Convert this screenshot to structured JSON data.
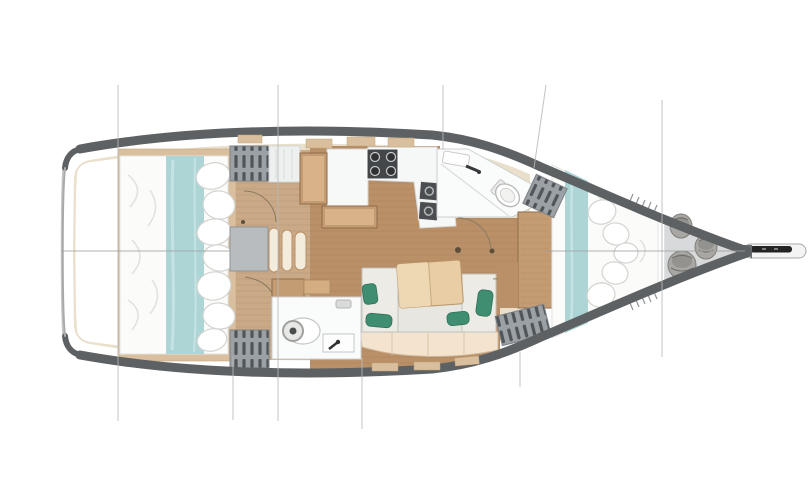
{
  "meta": {
    "type": "diagram",
    "subtype": "sailing-yacht-interior-floor-plan",
    "view": "top-down",
    "orientation": "bow-right, stern-left"
  },
  "palette": {
    "background": "#ffffff",
    "hull_band": "#5e6163",
    "hull_outline": "#c6c6c6",
    "transom_edge": "#a9a9a9",
    "deck_trim": "#e9dfca",
    "salon_floor": "#ba9069",
    "corridor_floor": "#caa987",
    "furniture_wood": "#c49c73",
    "table_wood": "#e8cda5",
    "bedding_white": "#fbfbfa",
    "accent_teal": "#aed5d6",
    "cushion_gray": "#ecebe5",
    "backrest_cream": "#f3e3cf",
    "pillow_green": "#3f8e71",
    "appliance_dark": "#44474a",
    "hanging_locker_gray": "#9ca1a6",
    "bow_locker_gray": "#d8d9da",
    "rope_gray": "#a8a7a3",
    "stairs_gray": "#b9bcbf",
    "construction_line": "#b9b9b9"
  },
  "rooms": [
    {
      "id": "stern-platform",
      "name": "Stern transom platform"
    },
    {
      "id": "aft-cabin",
      "name": "Aft cabin with full-beam double berth"
    },
    {
      "id": "companionway",
      "name": "Companionway steps"
    },
    {
      "id": "galley",
      "name": "Galley with stove and twin sinks"
    },
    {
      "id": "nav-station",
      "name": "Chart table and bench"
    },
    {
      "id": "salon",
      "name": "Salon with settee and table"
    },
    {
      "id": "aft-head",
      "name": "Aft head with toilet and washbasin"
    },
    {
      "id": "forward-head",
      "name": "Forward head with shower, toilet and basin"
    },
    {
      "id": "forward-cabin",
      "name": "Forward cabin with V-berth"
    },
    {
      "id": "bow-locker",
      "name": "Bow sail locker with rope coils"
    },
    {
      "id": "bowsprit",
      "name": "Bowsprit with anchor roller"
    }
  ],
  "fixtures": {
    "stove_burners": 4,
    "galley_sinks": 2,
    "toilets": 2,
    "washbasins": 2,
    "hanging_lockers": 4,
    "door_swing_arcs": 4,
    "rope_coils": 3,
    "companionway_steps": 3,
    "berths": 2,
    "teal_bed_runners": 2
  },
  "construction": {
    "centerline_y": 251,
    "station_lines_x": [
      118,
      233,
      278,
      362,
      443,
      520,
      662
    ],
    "slanted_line": {
      "from": [
        546,
        85
      ],
      "to": [
        534,
        168
      ]
    }
  }
}
